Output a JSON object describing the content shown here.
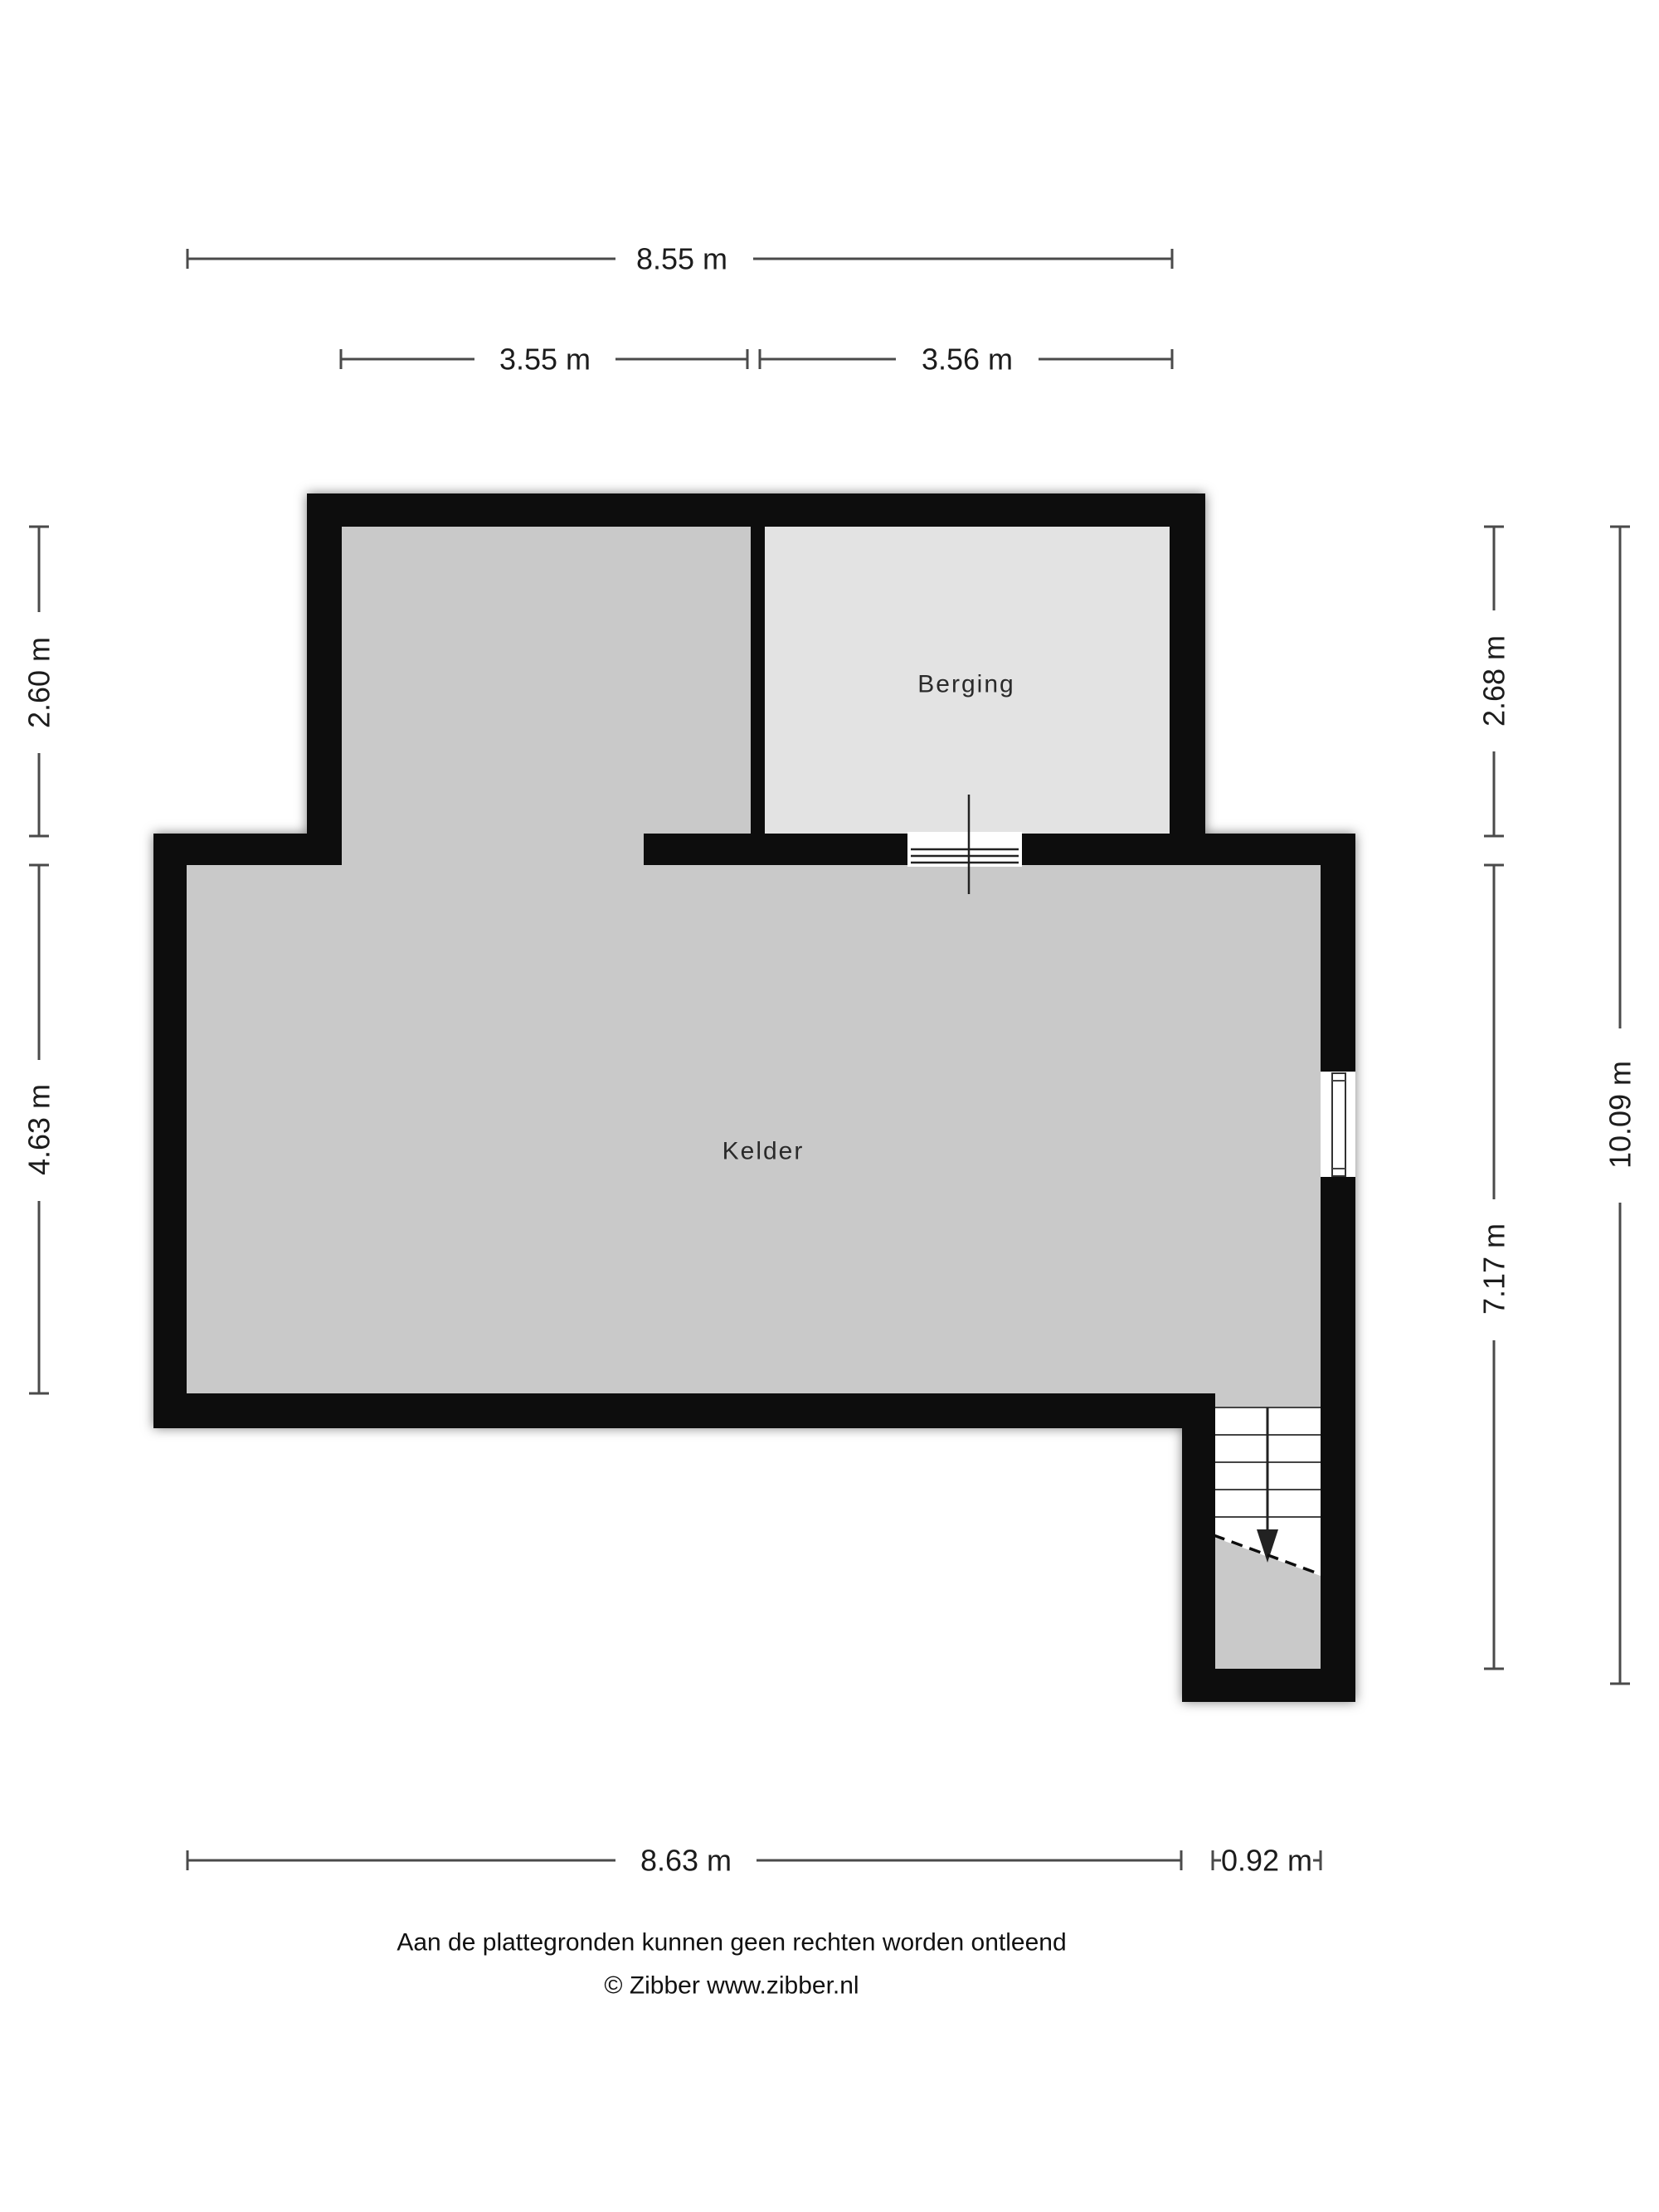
{
  "floorplan": {
    "rooms": {
      "berging": "Berging",
      "kelder": "Kelder"
    },
    "dimensions": {
      "top_total": "8.55 m",
      "upper_left_width": "3.55 m",
      "upper_right_width": "3.56 m",
      "left_upper_height": "2.60 m",
      "left_lower_height": "4.63 m",
      "right_upper_height": "2.68 m",
      "right_lower_height": "7.17 m",
      "right_total_height": "10.09 m",
      "bottom_width": "8.63 m",
      "bottom_stair_width": "0.92 m"
    },
    "colors": {
      "wall": "#0a0a0a",
      "floor_main": "#c9c9c9",
      "floor_storage": "#e3e3e3",
      "dimension_line": "#4a4a4a",
      "text": "#1c1c1c"
    },
    "footer": {
      "disclaimer": "Aan de plattegronden kunnen geen rechten worden ontleend",
      "credit": "© Zibber www.zibber.nl"
    }
  }
}
